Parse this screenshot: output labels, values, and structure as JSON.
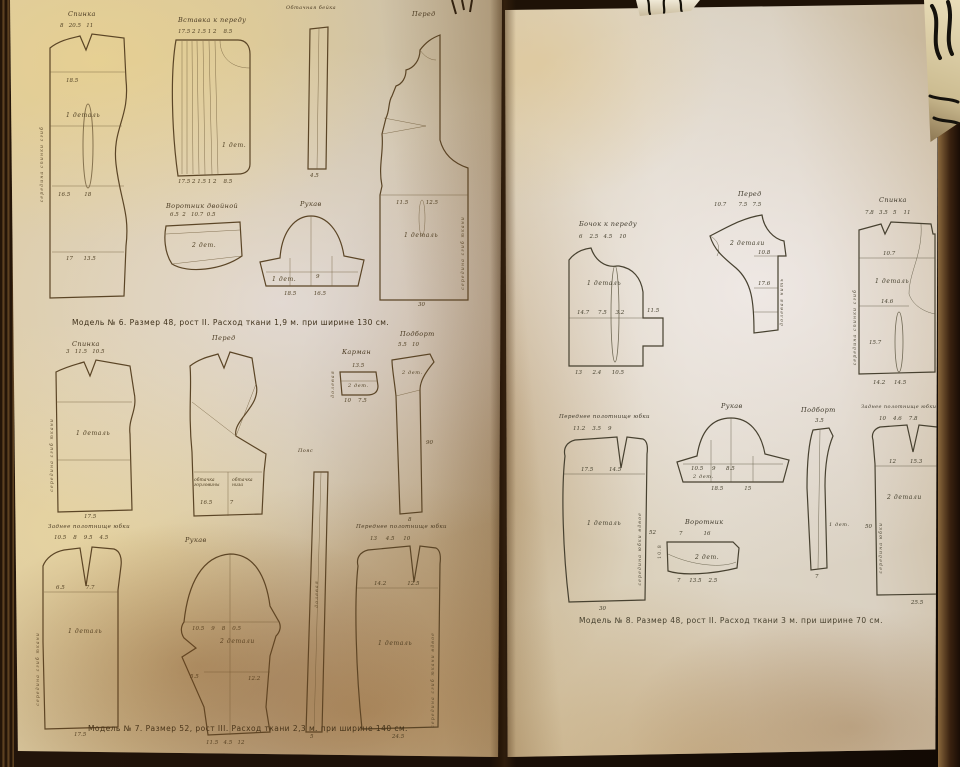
{
  "m6": {
    "caption": "Модель № 6. Размер 48, рост II. Расход ткани 1,9 м. при ширине 130 см.",
    "spinka": {
      "label": "Спинка",
      "detail": "1 деталь",
      "top": "8   20.5   11",
      "mid": "18.5",
      "mid2": "16.5        18",
      "bottom": "17      13.5",
      "fold": "середина спинки сгиб"
    },
    "vstavka": {
      "label": "Вставка к переду",
      "detail": "1 дет.",
      "top": "17.5 2 1.5 1 2    8.5",
      "bottom": "17.5 2 1.5 1 2    8.5"
    },
    "beika": {
      "label": "Обтачная бейка",
      "bottom": "4.5"
    },
    "pered": {
      "label": "Перед",
      "detail": "1 деталь",
      "mid": "11.5          12.5",
      "bottom": "30",
      "fold": "середина сгиб ткани"
    },
    "vorotnik": {
      "label": "Воротник двойной",
      "detail": "2 дет.",
      "top": "6.5  2   10.7  0.5"
    },
    "rukav": {
      "label": "Рукав",
      "detail": "1 дет.",
      "mid": "9",
      "bottom": "18.5          16.5"
    }
  },
  "m7": {
    "caption": "Модель № 7. Размер 52, рост III. Расход ткани 2,3 м. при ширине 140 см.",
    "spinka": {
      "label": "Спинка",
      "detail": "1 деталь",
      "top": "3   11.5   10.5",
      "bottom": "17.5",
      "fold": "середина сгиб ткани"
    },
    "pered": {
      "label": "Перед",
      "sub1": "обтачка горловины",
      "sub2": "обтачка низа",
      "subnum": "16.5          7"
    },
    "karman": {
      "label": "Карман",
      "detail": "2 дет.",
      "top": "13.5",
      "bottom": "10    7.5",
      "side": "долевая"
    },
    "podbort": {
      "label": "Подборт",
      "detail": "2 дет.",
      "top": "5.5   10",
      "side": "90",
      "bottom": "8"
    },
    "zadnee": {
      "label": "Заднее полотнище юбки",
      "detail": "1 деталь",
      "top": "10.5    8    9.5    4.5",
      "mid": "6.5            7.7",
      "bottom": "17.5",
      "fold": "середина сгиб ткани"
    },
    "rukav": {
      "label": "Рукав",
      "detail": "2 детали",
      "top": "10.5    9    8    0.5",
      "mid": "12.2",
      "side": "5.5",
      "bottom": "11.5   4.5   12"
    },
    "poyas": {
      "label": "Пояс",
      "side": "долевая",
      "bottom": "5"
    },
    "perednee": {
      "label": "Переднее полотнище юбки",
      "detail": "1 деталь",
      "top": "13     4.5     10",
      "mid": "14.2            12.5",
      "bottom": "24.5",
      "fold": "середина сгиб ткани вдвое"
    }
  },
  "m8": {
    "caption": "Модель № 8. Размер 48, рост II. Расход ткани 3 м. при ширине 70 см.",
    "bochok": {
      "label": "Бочок к переду",
      "detail": "1 деталь",
      "top": "6    2.5   4.5    10",
      "mid": "14.7     7.5     3.2",
      "bottom": "13      2.4      10.5",
      "side": "11.5"
    },
    "pered": {
      "label": "Перед",
      "detail": "2 детали",
      "top": "10.7       7.5   7.5",
      "mid": "10.8",
      "mid2": "17.6",
      "fold": "долевая нить"
    },
    "spinka": {
      "label": "Спинка",
      "detail": "1 деталь",
      "top": "7.8   3.5   5    11",
      "mid": "10.7",
      "mid2": "14.6",
      "mid3": "15.7",
      "bottom": "14.2     14.5",
      "fold": "середина спинки сгиб"
    },
    "perednee": {
      "label": "Переднее полотнище юбки",
      "detail": "1 деталь",
      "top": "11.2    3.5    9",
      "mid": "17.5         14.5",
      "side": "52",
      "bottom": "30",
      "fold": "середина юбки вдвое"
    },
    "rukav": {
      "label": "Рукав",
      "detail": "2 дет.",
      "mid": "10.5     9      8.5",
      "bottom": "18.5            15"
    },
    "vorotnik": {
      "label": "Воротник",
      "detail": "2 дет.",
      "top": "7            16",
      "side": "10.8",
      "bottom": "7     13.5    2.5"
    },
    "podbort": {
      "label": "Подборт",
      "detail": "1 дет.",
      "top": "3.5",
      "bottom": "7"
    },
    "zadnee": {
      "label": "Заднее полотнище юбки",
      "detail": "2 детали",
      "top": "10    4.6    7.8",
      "mid": "12        15.3",
      "side": "50",
      "bottom": "25.5",
      "fold": "середина юбки"
    }
  }
}
